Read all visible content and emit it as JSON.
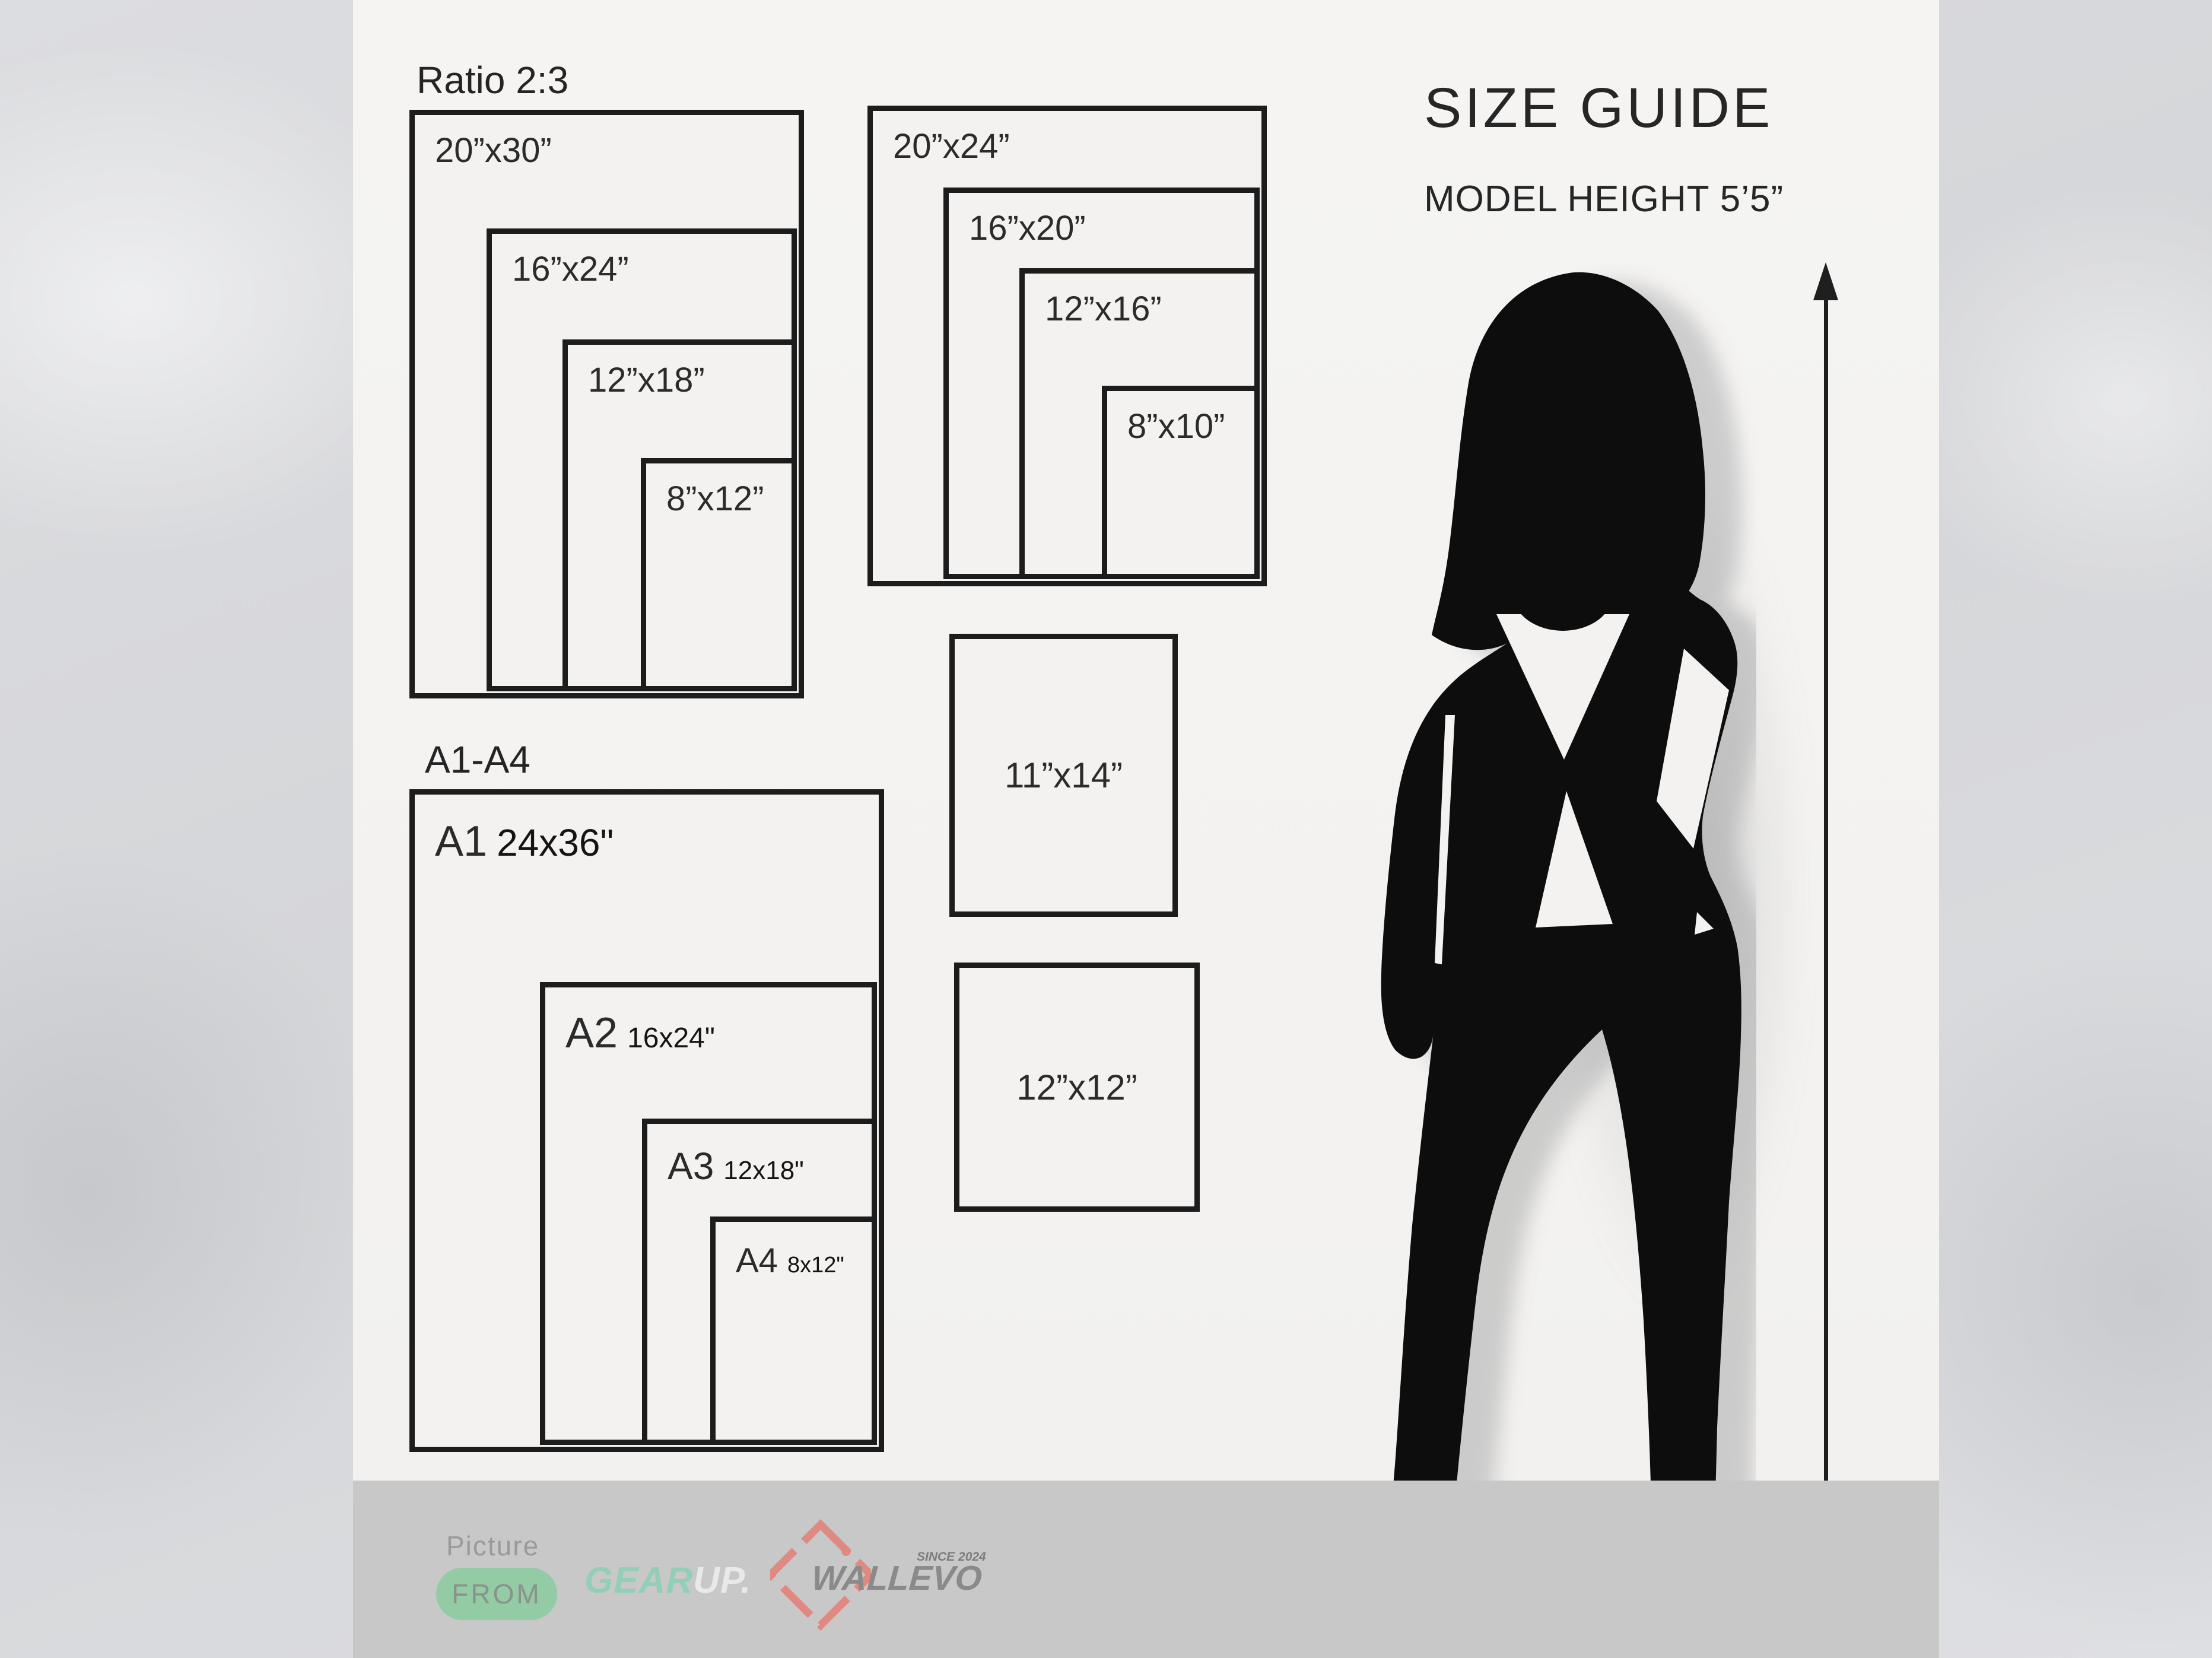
{
  "header": {
    "title": "SIZE GUIDE",
    "subtitle": "MODEL HEIGHT 5’5”"
  },
  "ratio_group": {
    "title": "Ratio 2:3",
    "sizes": [
      "20”x30”",
      "16”x24”",
      "12”x18”",
      "8”x12”"
    ]
  },
  "standard_group": {
    "sizes": [
      "20”x24”",
      "16”x20”",
      "12”x16”",
      "8”x10”"
    ]
  },
  "a_series": {
    "title": "A1-A4",
    "items": [
      {
        "code": "A1",
        "size": "24x36\""
      },
      {
        "code": "A2",
        "size": "16x24\""
      },
      {
        "code": "A3",
        "size": "12x18\""
      },
      {
        "code": "A4",
        "size": "8x12\""
      }
    ]
  },
  "squares": {
    "portrait": "11”x14”",
    "square": "12”x12”"
  },
  "footer": {
    "picture": "Picture",
    "from": "FROM",
    "gearup_gear": "GEAR",
    "gearup_up": "UP.",
    "wallevo": "WALLEVO",
    "since": "SINCE 2024"
  },
  "colors": {
    "ink": "#1C1C1C",
    "panel": "#F3F2F1",
    "footer_bar": "#C8C8C9",
    "accent_green_pill": "#93CBA5",
    "accent_mint": "#93CFB6",
    "accent_salmon": "#E08983"
  }
}
